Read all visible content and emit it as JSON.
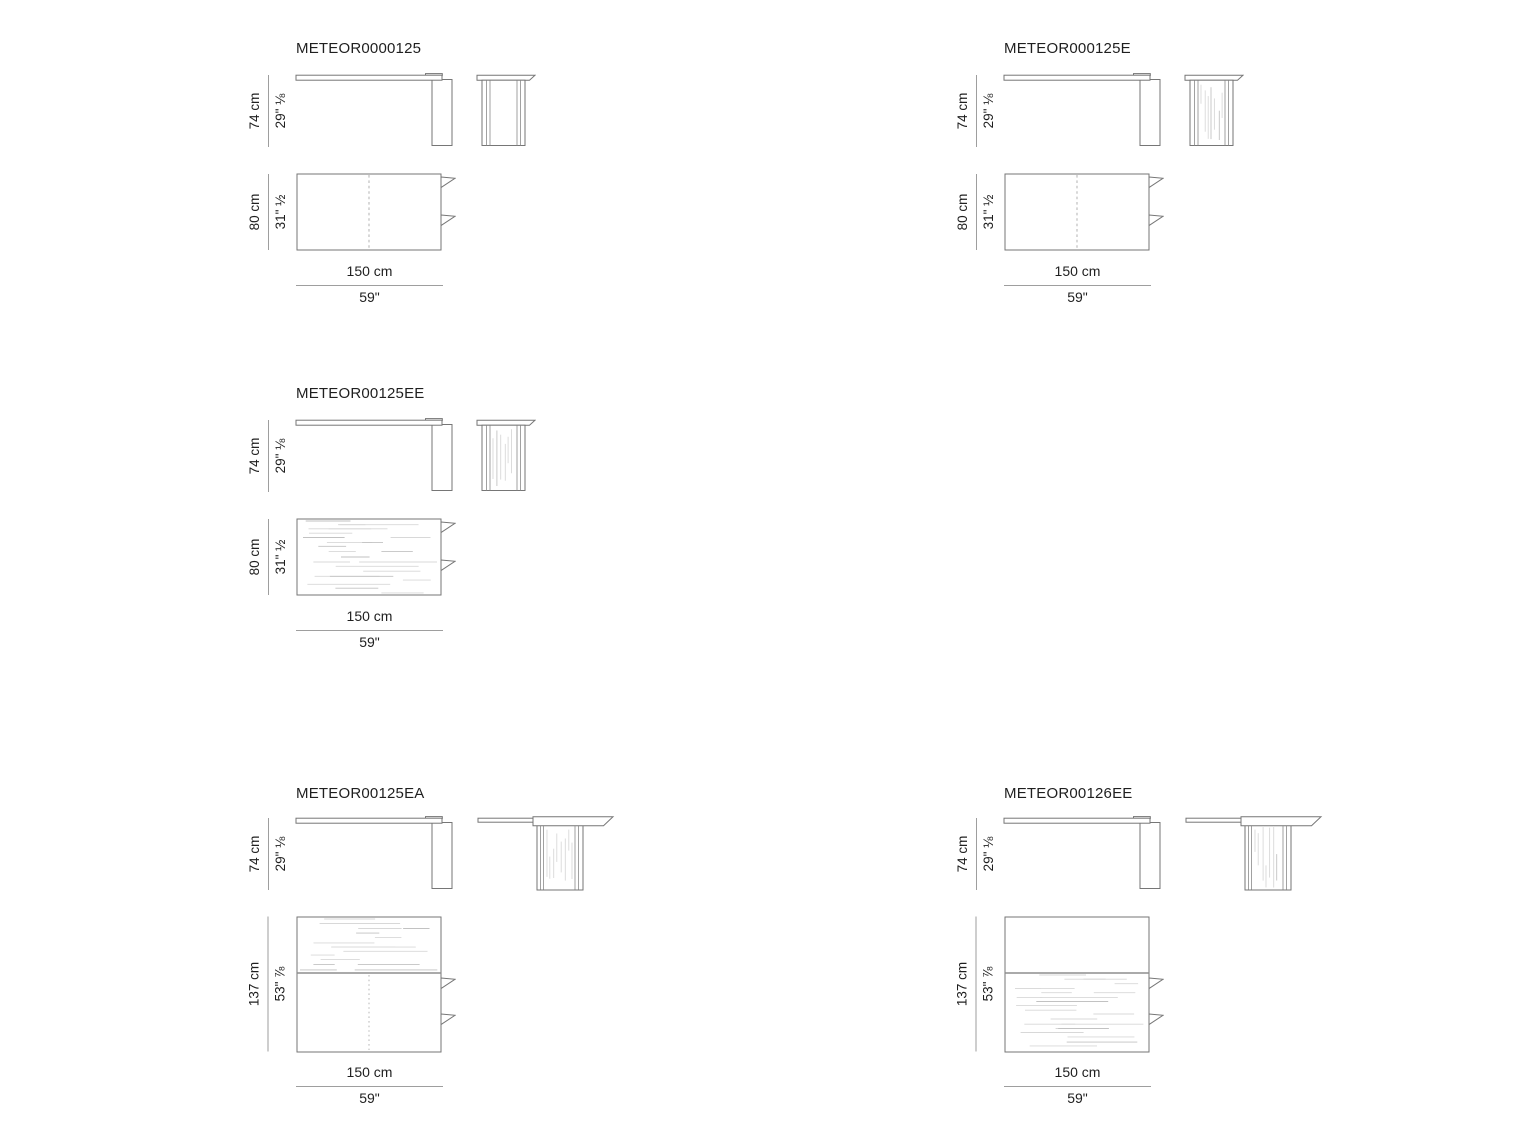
{
  "document": {
    "kind": "furniture dimension sheet",
    "background_color": "#ffffff",
    "outline_color": "#767676",
    "dimension_line_color": "#9e9e9e",
    "wood_grain_color": "#d8d8d8",
    "text_color": "#1f1f1f"
  },
  "panels": [
    {
      "title": "METEOR0000125",
      "height": {
        "cm": "74 cm",
        "inches": "29\" ⅛"
      },
      "depth": {
        "cm": "80 cm",
        "inches": "31\" ½"
      },
      "width": {
        "cm": "150 cm",
        "inches": "59\""
      }
    },
    {
      "title": "METEOR000125E",
      "height": {
        "cm": "74 cm",
        "inches": "29\" ⅛"
      },
      "depth": {
        "cm": "80 cm",
        "inches": "31\" ½"
      },
      "width": {
        "cm": "150 cm",
        "inches": "59\""
      }
    },
    {
      "title": "METEOR00125EE",
      "height": {
        "cm": "74 cm",
        "inches": "29\" ⅛"
      },
      "depth": {
        "cm": "80 cm",
        "inches": "31\" ½"
      },
      "width": {
        "cm": "150 cm",
        "inches": "59\""
      }
    },
    {
      "title": "METEOR00125EA",
      "height": {
        "cm": "74 cm",
        "inches": "29\" ⅛"
      },
      "depth": {
        "cm": "137 cm",
        "inches": "53\" ⅞"
      },
      "width": {
        "cm": "150 cm",
        "inches": "59\""
      }
    },
    {
      "title": "METEOR00126EE",
      "height": {
        "cm": "74 cm",
        "inches": "29\" ⅛"
      },
      "depth": {
        "cm": "137 cm",
        "inches": "53\" ⅞"
      },
      "width": {
        "cm": "150 cm",
        "inches": "59\""
      }
    }
  ]
}
